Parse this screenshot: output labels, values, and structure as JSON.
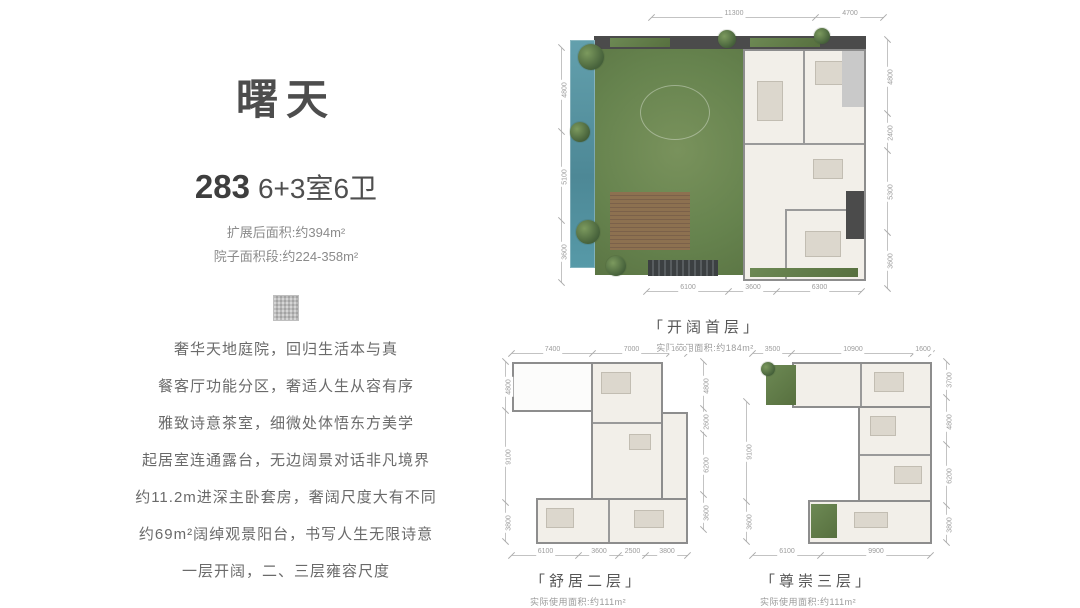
{
  "left_panel": {
    "title": "曙天",
    "area_number": "283",
    "spec": "6+3室6卫",
    "expanded_area": "扩展后面积:约394m²",
    "yard_area": "院子面积段:约224-358m²",
    "features": [
      "奢华天地庭院，回归生活本与真",
      "餐客厅功能分区，奢适人生从容有序",
      "雅致诗意茶室，细微处体悟东方美学",
      "起居室连通露台，无边阔景对话非凡境界",
      "约11.2m进深主卧套房，奢阔尺度大有不同",
      "约69m²阔绰观景阳台，书写人生无限诗意",
      "一层开阔，二、三层雍容尺度"
    ]
  },
  "plans": [
    {
      "name": "「开阔首层」",
      "area": "实际使用面积:约184m²",
      "dims_top": [
        "11300",
        "4700"
      ],
      "dims_left": [
        "4800",
        "5100",
        "3600"
      ],
      "dims_right": [
        "4800",
        "2400",
        "5300",
        "3600"
      ],
      "dims_bottom": [
        "6100",
        "3600",
        "6300"
      ]
    },
    {
      "name": "「舒居二层」",
      "area": "实际使用面积:约111m²",
      "dims_top": [
        "7400",
        "7000",
        "1600"
      ],
      "dims_left": [
        "4800",
        "9100",
        "3800"
      ],
      "dims_right": [
        "4800",
        "2600",
        "6200",
        "3600"
      ],
      "dims_bottom": [
        "6100",
        "3600",
        "2500",
        "3800"
      ]
    },
    {
      "name": "「尊崇三层」",
      "area": "实际使用面积:约111m²",
      "dims_top": [
        "3500",
        "10900",
        "1600"
      ],
      "dims_left": [
        "9100",
        "3600"
      ],
      "dims_right": [
        "3700",
        "4800",
        "6200",
        "3800"
      ],
      "dims_bottom": [
        "6100",
        "9900"
      ]
    }
  ],
  "colors": {
    "pool": "#579aa8",
    "lawn": "#66834e",
    "roof_dark": "#4b4b4b",
    "deck_wood": "#8d7150",
    "text_dark": "#4d4d4d"
  }
}
